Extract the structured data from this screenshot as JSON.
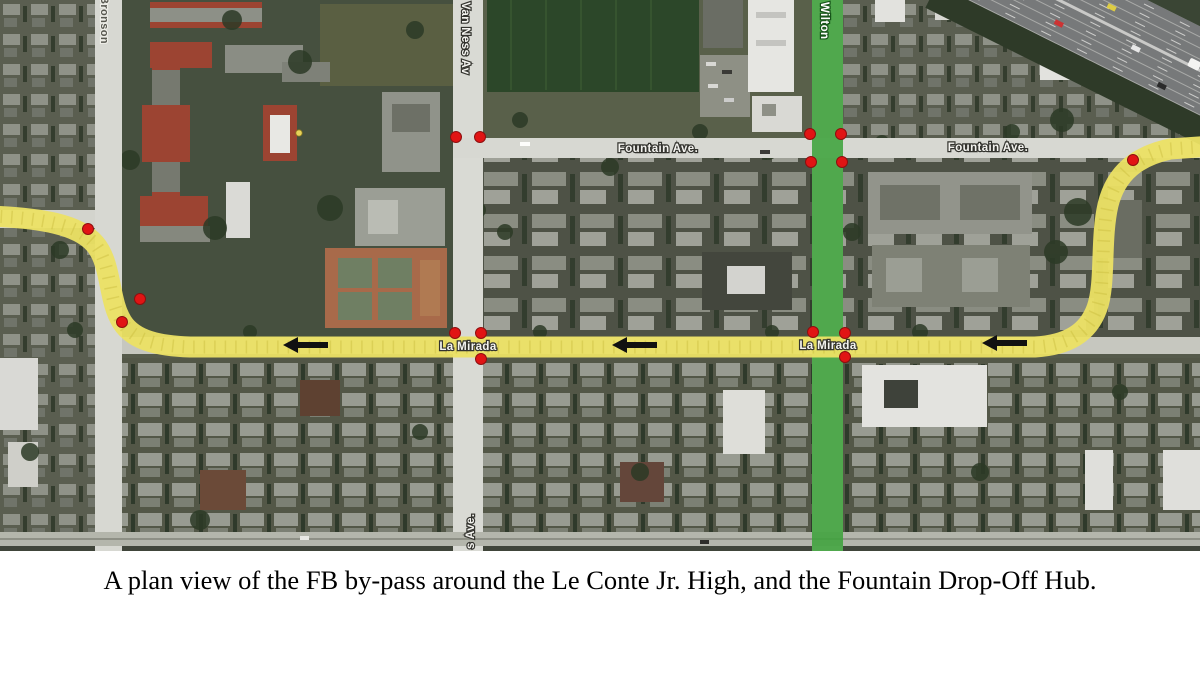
{
  "figure": {
    "caption": "A plan view of the FB by-pass around the Le Conte Jr. High, and the Fountain Drop-Off Hub."
  },
  "map": {
    "labels": {
      "fountain_1": "Fountain Ave.",
      "fountain_2": "Fountain Ave.",
      "la_mirada_1": "La Mirada",
      "la_mirada_2": "La Mirada",
      "van_ness": "Van Ness Av",
      "van_ness_fragment": "s Ave.",
      "bronson": "Bronson",
      "wilton": "Wilton"
    },
    "route": {
      "name": "FB by-pass",
      "color": "#ece264",
      "direction": "westbound",
      "arrow_count": 3
    },
    "hub_street": {
      "name": "Wilton",
      "highlight_color": "#3fa33c"
    },
    "markers": {
      "color": "#e11414",
      "count": 16
    }
  }
}
